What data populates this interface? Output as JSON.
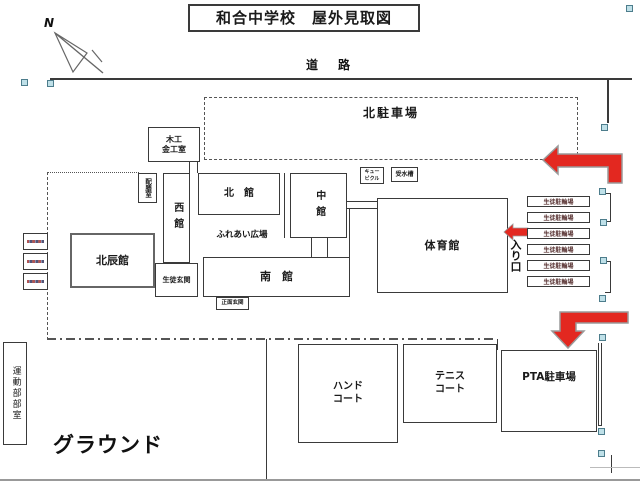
{
  "title": "和合中学校　屋外見取図",
  "compass": {
    "north_label": "N"
  },
  "labels": {
    "road": "道　路",
    "north_parking": "北駐車場",
    "fureai_plaza": "ふれあい広場",
    "entrance": "入り口",
    "ground": "グラウンド"
  },
  "buildings": {
    "woodwork_metalwork_room": "木工\n金工室",
    "serving_room": "配膳室",
    "west_hall": "西館",
    "north_hall": "北　館",
    "middle_hall": "中館",
    "cubicle": "キュー\nビクル",
    "water_tank": "受水槽",
    "gymnasium": "体育館",
    "hokushin_hall": "北辰館",
    "south_hall": "南　館",
    "student_entrance": "生徒玄関",
    "main_entrance": "正面玄関",
    "sports_club_rooms": "運動部部室"
  },
  "bike_parking": {
    "labels": [
      "生徒駐輪場",
      "生徒駐輪場",
      "生徒駐輪場",
      "生徒駐輪場",
      "生徒駐輪場",
      "生徒駐輪場"
    ]
  },
  "areas": {
    "hand_court": "ハンド\nコート",
    "tennis_court": "テニス\nコート",
    "pta_parking": "PTA駐車場"
  },
  "colors": {
    "arrow_red": "#e32820",
    "arrow_outline": "#9a9a9a",
    "handle_fill": "#bfe0e8",
    "line_dark": "#3a3a3a"
  }
}
